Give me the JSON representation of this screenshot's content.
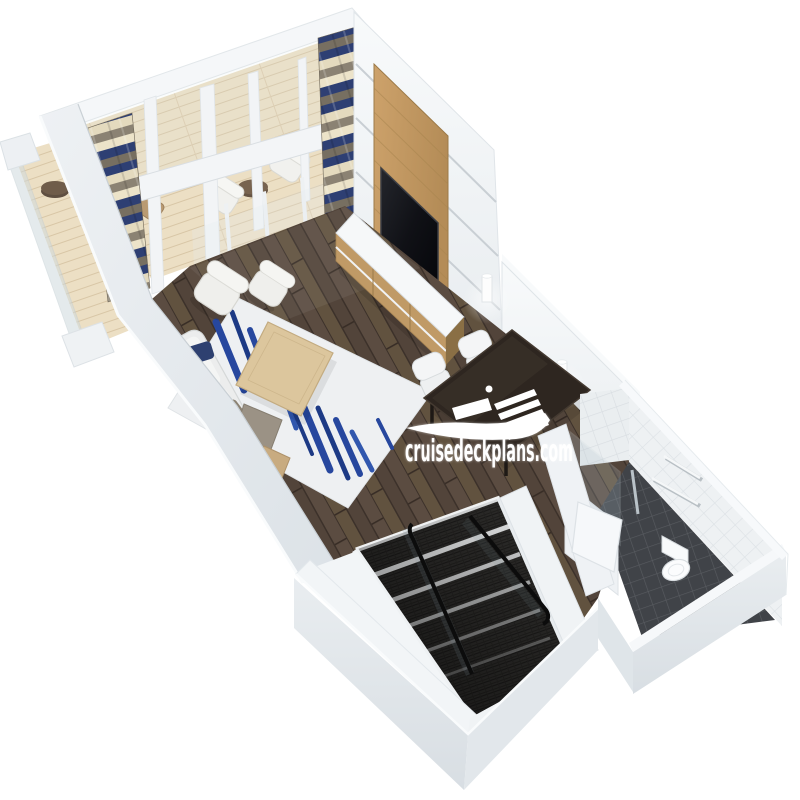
{
  "scene": {
    "title": "3D cutaway floor plan render of a two-deck loft suite",
    "style": "isometric 3D render on white background",
    "rooms": [
      "balcony",
      "living-room",
      "dining-area",
      "bathroom",
      "staircase"
    ]
  },
  "watermark": {
    "text": "cruisedeckplans.com",
    "icon": "cruise-ship-icon",
    "color": "#ffffff"
  },
  "palette": {
    "background": "#ffffff",
    "wall_light": "#f4f6f8",
    "wall_shadow": "#dde3e7",
    "wood_floor": "#584a3f",
    "balcony_deck": "#e9dcc1",
    "curtain_navy": "#2e3f73",
    "curtain_taupe": "#8b8273",
    "curtain_cream": "#ece3c9",
    "tv_panel_oak": "#c39a64",
    "tv_screen": "#17181c",
    "dining_table": "#2e2620",
    "rug_base": "#eef0f2",
    "rug_accent_blue": "#27479e",
    "stair_carpet": "#2d2c2a",
    "bathroom_floor_tile": "#3f4145",
    "bathroom_wall_tile": "#eef1f3"
  }
}
